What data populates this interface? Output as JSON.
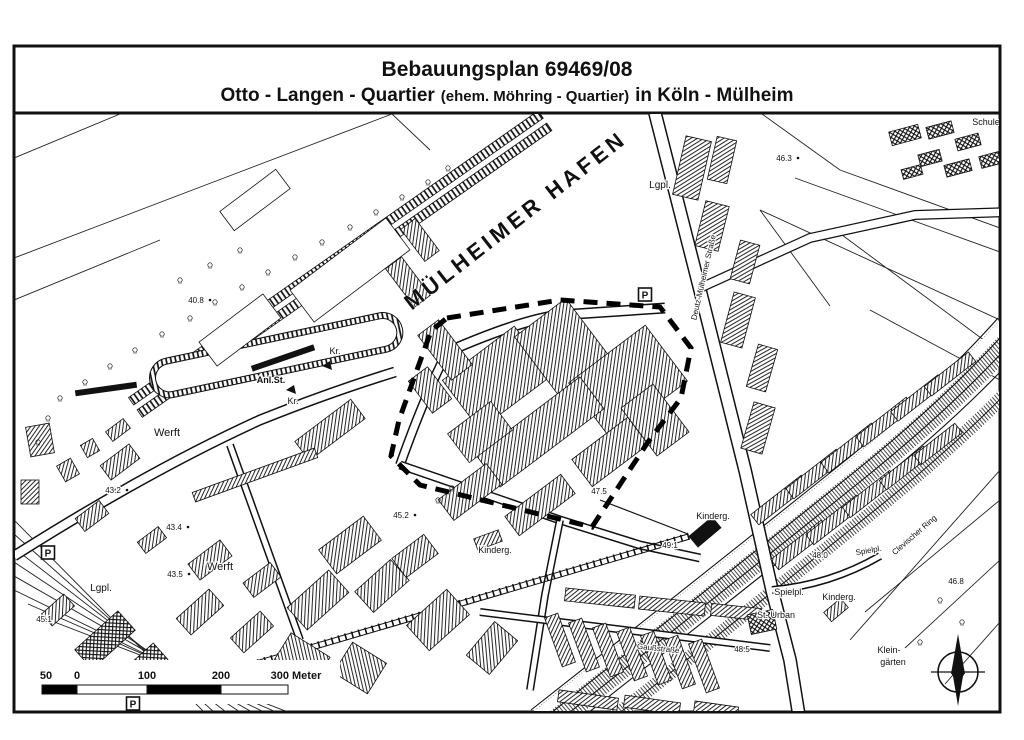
{
  "title": {
    "line1": "Bebauungsplan 69469/08",
    "line2_main": "Otto - Langen - Quartier",
    "line2_small": "(ehem. Möhring - Quartier)",
    "line2_end": "in Köln - Mülheim"
  },
  "map": {
    "parking_label": "P",
    "parking_signs": [
      {
        "x": 48,
        "y": 553
      },
      {
        "x": 645,
        "y": 295
      },
      {
        "x": 133,
        "y": 704
      }
    ],
    "labels": [
      {
        "text": "MÜLHEIMER HAFEN",
        "x": 520,
        "y": 226,
        "rot": -38,
        "size": 22,
        "bold": true,
        "spacing": 4,
        "name": "harbor-name-label",
        "harbor": true
      },
      {
        "text": "Werft",
        "x": 167,
        "y": 436,
        "size": 11,
        "name": "werft-label"
      },
      {
        "text": "Werft",
        "x": 220,
        "y": 570,
        "size": 11,
        "name": "werft-label"
      },
      {
        "text": "Lgpl.",
        "x": 101,
        "y": 591,
        "size": 10,
        "name": "lagerplatz-label"
      },
      {
        "text": "Lgpl.",
        "x": 660,
        "y": 188,
        "size": 10,
        "name": "lagerplatz-label"
      },
      {
        "text": "Kr.",
        "x": 335,
        "y": 354,
        "size": 9,
        "name": "kran-label"
      },
      {
        "text": "Kr.",
        "x": 293,
        "y": 404,
        "size": 9,
        "name": "kran-label"
      },
      {
        "text": "Anl.St.",
        "x": 271,
        "y": 383,
        "size": 9,
        "bold": true,
        "name": "anlegestelle-label"
      },
      {
        "text": "40.8",
        "x": 196,
        "y": 303,
        "size": 8,
        "dot": true,
        "name": "height-label"
      },
      {
        "text": "43.2",
        "x": 113,
        "y": 493,
        "size": 8,
        "dot": true,
        "name": "height-label"
      },
      {
        "text": "43.4",
        "x": 174,
        "y": 530,
        "size": 8,
        "dot": true,
        "name": "height-label"
      },
      {
        "text": "43.5",
        "x": 175,
        "y": 577,
        "size": 8,
        "dot": true,
        "name": "height-label"
      },
      {
        "text": "45.1",
        "x": 44,
        "y": 622,
        "size": 8,
        "name": "height-label"
      },
      {
        "text": "45.2",
        "x": 401,
        "y": 518,
        "size": 8,
        "dot": true,
        "name": "height-label"
      },
      {
        "text": "46.3",
        "x": 784,
        "y": 161,
        "size": 8,
        "dot": true,
        "name": "height-label"
      },
      {
        "text": "47.5",
        "x": 599,
        "y": 494,
        "size": 8,
        "name": "height-label"
      },
      {
        "text": "49.1",
        "x": 670,
        "y": 548,
        "size": 8,
        "name": "height-label"
      },
      {
        "text": "48.0",
        "x": 820,
        "y": 558,
        "size": 8,
        "name": "height-label"
      },
      {
        "text": "46.8",
        "x": 956,
        "y": 584,
        "size": 8,
        "name": "height-label"
      },
      {
        "text": "48.5",
        "x": 742,
        "y": 652,
        "size": 8,
        "name": "height-label"
      },
      {
        "text": "Kinderg.",
        "x": 713,
        "y": 519,
        "size": 9,
        "name": "kindergarten-label"
      },
      {
        "text": "Kinderg.",
        "x": 495,
        "y": 553,
        "size": 9,
        "name": "kindergarten-label"
      },
      {
        "text": "Kinderg.",
        "x": 839,
        "y": 600,
        "size": 9,
        "name": "kindergarten-label"
      },
      {
        "text": "Spielpl.",
        "x": 789,
        "y": 595,
        "size": 9,
        "name": "spielplatz-label"
      },
      {
        "text": "Spielpl.",
        "x": 869,
        "y": 553,
        "size": 8,
        "rot": -10,
        "name": "spielplatz-label"
      },
      {
        "text": "St. Urban",
        "x": 776,
        "y": 618,
        "size": 9,
        "name": "church-label"
      },
      {
        "text": "Klein-",
        "x": 889,
        "y": 653,
        "size": 9,
        "name": "kleingaerten-label"
      },
      {
        "text": "gärten",
        "x": 893,
        "y": 665,
        "size": 9,
        "name": "kleingaerten-label"
      },
      {
        "text": "Schule",
        "x": 986,
        "y": 125,
        "size": 9,
        "name": "schule-label"
      },
      {
        "text": "Deutz-Mülheimer Straße",
        "x": 706,
        "y": 278,
        "rot": -77,
        "size": 8,
        "name": "street-label-deutz-muelheimer-strasse"
      },
      {
        "text": "Clevischer Ring",
        "x": 916,
        "y": 537,
        "rot": -41,
        "size": 8,
        "name": "street-label-clevischer-ring"
      },
      {
        "text": "Gaußstraße",
        "x": 658,
        "y": 651,
        "rot": 6,
        "size": 8,
        "name": "street-label-gaussstrasse"
      }
    ]
  },
  "scalebar": {
    "ticks": [
      {
        "label": "50",
        "x": 46
      },
      {
        "label": "0",
        "x": 77
      },
      {
        "label": "100",
        "x": 147
      },
      {
        "label": "200",
        "x": 221
      },
      {
        "label": "300 Meter",
        "x": 296
      }
    ],
    "segments": [
      {
        "x0": 42,
        "x1": 77,
        "fill": "#000000"
      },
      {
        "x0": 77,
        "x1": 147,
        "fill": "#ffffff"
      },
      {
        "x0": 147,
        "x1": 221,
        "fill": "#000000"
      },
      {
        "x0": 221,
        "x1": 288,
        "fill": "#ffffff"
      }
    ]
  },
  "compass": {
    "label": "N"
  },
  "colors": {
    "ink": "#111111",
    "paper": "#ffffff"
  }
}
